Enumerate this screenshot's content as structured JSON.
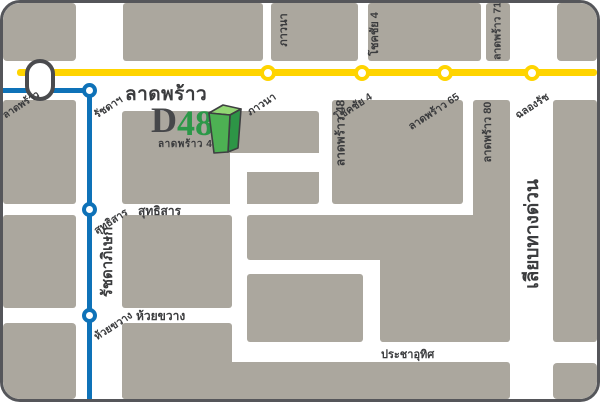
{
  "map_title": "D48 ลาดพร้าว 48 location map",
  "colors": {
    "block": "#ABA79E",
    "yellow_line": "#FFD400",
    "blue_line": "#0E72B8",
    "border": "#55565A",
    "text_dark": "#3B3C3E",
    "logo_green": "#2B9848",
    "logo_gray": "#46474A",
    "building_front": "#4DB153",
    "building_top": "#92D774",
    "building_side": "#2D9546",
    "building_outline": "#3E3F41"
  },
  "logo": {
    "prefix": "D",
    "number": "48",
    "subtitle": "ลาดพร้าว 48"
  },
  "roads": {
    "main": "ลาดพร้าว",
    "sutthisan": "สุทธิสาร",
    "huai_khwang": "ห้วยขวาง",
    "pracha_uthit": "ประชาอุทิศ",
    "ratchadaphisek": "รัชดาภิเษก",
    "expressway": "เลียบทางด่วน",
    "soi_phawana": "ภาวนา",
    "soi_chokchai4": "โชคชัย 4",
    "soi_71": "ลาดพร้าว 71",
    "soi_48": "ลาดพร้าว 48",
    "soi_80": "ลาดพร้าว 80"
  },
  "yellow_stations": [
    {
      "label": "ภาวนา"
    },
    {
      "label": "โชคชัย 4"
    },
    {
      "label": "ลาดพร้าว 65"
    },
    {
      "label": "ฉลองรัช"
    }
  ],
  "blue_stations": [
    {
      "label": "ลาดพร้าว"
    },
    {
      "label": "รัชดาฯ"
    },
    {
      "label": "สุทธิสาร"
    },
    {
      "label": "ห้วยขวาง"
    }
  ]
}
